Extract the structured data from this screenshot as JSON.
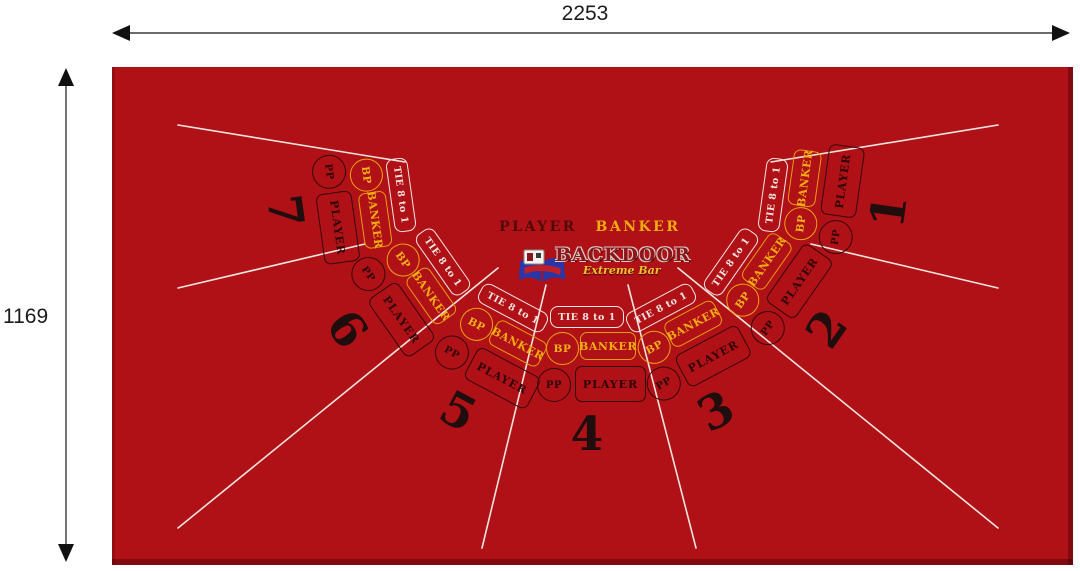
{
  "dimension_labels": {
    "width": "2253",
    "height": "1169"
  },
  "felt": {
    "center_player_label": "PLAYER",
    "center_banker_label": "BANKER",
    "logo": {
      "title": "BACKDOOR",
      "tagline": "Extreme Bar"
    },
    "bet_labels": {
      "tie": "TIE 8 to 1",
      "banker": "BANKER",
      "player": "PLAYER",
      "banker_pair": "BP",
      "player_pair": "PP"
    },
    "seats": [
      {
        "number": "1"
      },
      {
        "number": "2"
      },
      {
        "number": "3"
      },
      {
        "number": "4"
      },
      {
        "number": "5"
      },
      {
        "number": "6"
      },
      {
        "number": "7"
      }
    ]
  },
  "colors": {
    "felt": "#b01117",
    "felt_edge": "#7d0d12",
    "gold": "#f2ac14",
    "dark_bet": "#2e0607",
    "white_line": "#f2e4de",
    "center_player_text": "#4f0b08",
    "logo_blue": "#2a35a8"
  }
}
